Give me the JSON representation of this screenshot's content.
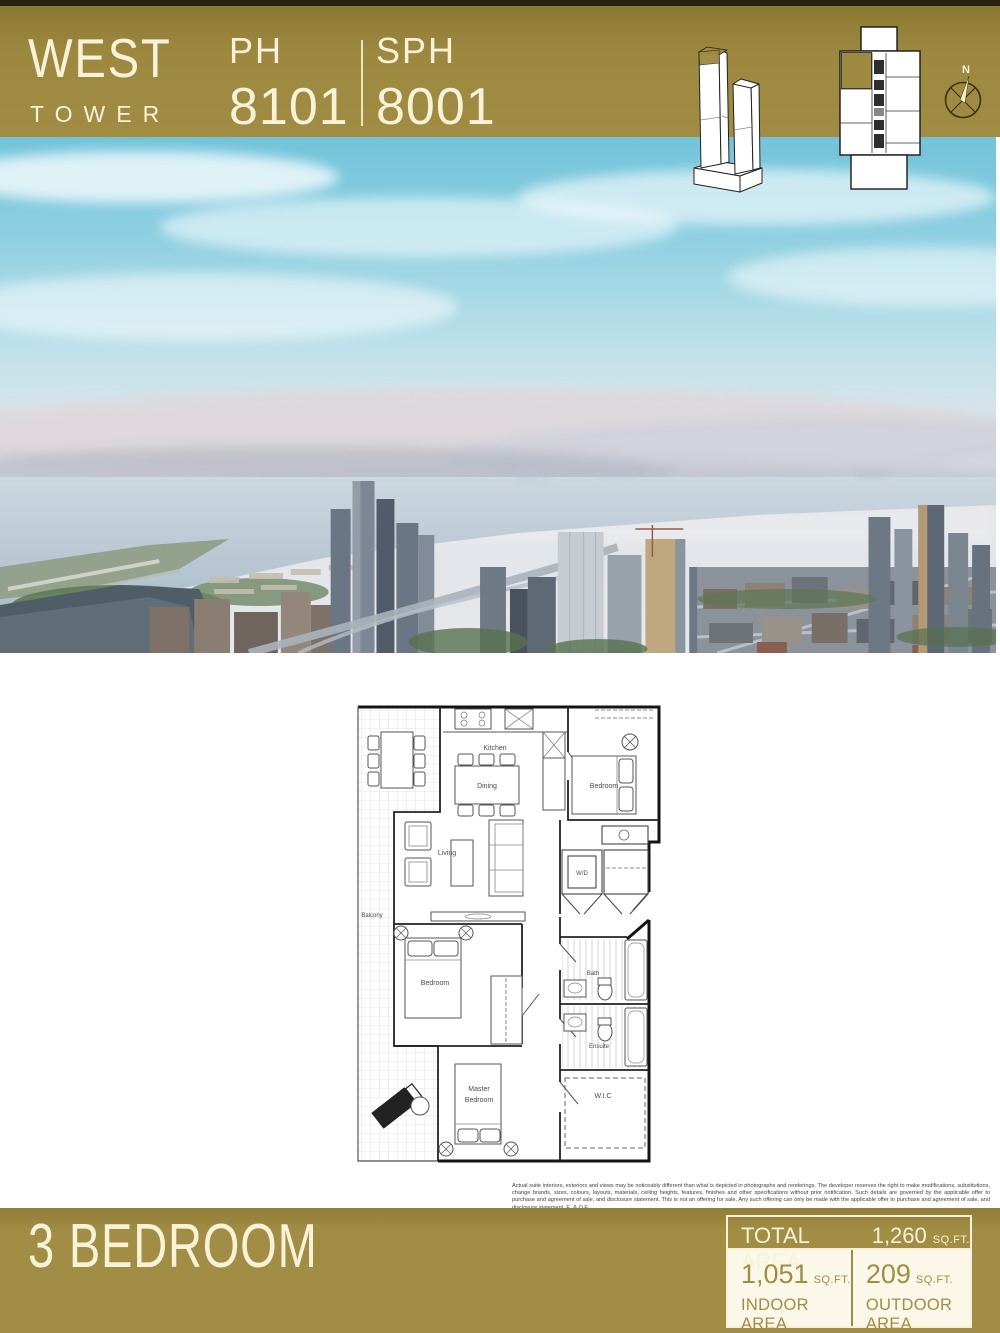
{
  "header": {
    "tower_line1": "WEST",
    "tower_line2": "TOWER",
    "suite1": {
      "prefix": "PH",
      "number": "8101"
    },
    "suite2": {
      "prefix": "SPH",
      "number": "8001"
    },
    "compass_n": "N"
  },
  "floor_plan": {
    "labels": {
      "kitchen": "Kitchen",
      "dining": "Dining",
      "living": "Living",
      "bedroom_top": "Bedroom",
      "bedroom_mid": "Bedroom",
      "master_line1": "Master",
      "master_line2": "Bedroom",
      "wd": "W/D",
      "bath": "Bath",
      "ensuite": "Ensuite",
      "wic": "W.I.C",
      "balcony": "Balcony"
    }
  },
  "disclaimer": "Actual suite interiors, exteriors and views may be noticeably different than what is depicted in photographs and renderings. The developer reserves the right to make modifications, substitutions, change brands, sizes, colours, layouts, materials, ceiling heights, features, finishes and other specifications without prior notification. Such details are governed by the applicable offer to purchase and agreement of sale, and disclosure statement. This is not an offering for sale. Any such offering can only be made with the applicable offer to purchase and agreement of sale, and disclosure statement. E. & O.E.",
  "footer": {
    "plan_type": "3 BEDROOM",
    "total": {
      "label": "TOTAL AREA",
      "value": "1,260",
      "unit": "SQ.FT."
    },
    "indoor": {
      "value": "1,051",
      "unit": "SQ.FT.",
      "label": "INDOOR AREA"
    },
    "outdoor": {
      "value": "209",
      "unit": "SQ.FT.",
      "label": "OUTDOOR AREA"
    }
  },
  "colors": {
    "gold": "#9e8940",
    "cream": "#f7f2d8"
  }
}
